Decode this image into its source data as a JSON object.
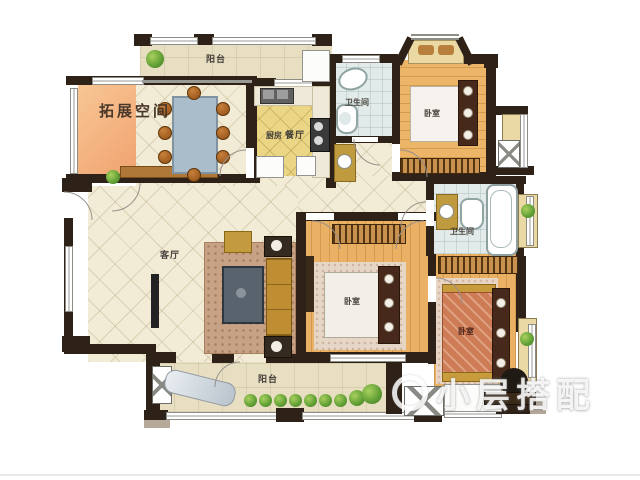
{
  "title": "apartment-floorplan",
  "rooms": [
    {
      "id": "extension-space",
      "label": "拓展空间"
    },
    {
      "id": "balcony-top",
      "label": "阳台"
    },
    {
      "id": "dining-room",
      "label": "餐厅"
    },
    {
      "id": "kitchen",
      "label": "厨房"
    },
    {
      "id": "bathroom-top",
      "label": "卫生间"
    },
    {
      "id": "bedroom-top-right",
      "label": "卧室"
    },
    {
      "id": "bathroom-right",
      "label": "卫生间"
    },
    {
      "id": "living-room",
      "label": "客厅"
    },
    {
      "id": "bedroom-middle",
      "label": "卧室"
    },
    {
      "id": "bedroom-bottom-right",
      "label": "卧室"
    },
    {
      "id": "balcony-bottom",
      "label": "阳台"
    }
  ],
  "watermark": {
    "text": "小层搭配"
  },
  "colors": {
    "wall": "#2e2117",
    "tile_floor": "#f2ecd6",
    "wood_floor": "#ecb568",
    "kitchen_floor": "#ead685",
    "bathroom_floor": "#e2ebe9",
    "balcony_floor": "#e8dec2",
    "extension_fill": "#f0a470",
    "plant_green": "#5f9e34"
  }
}
